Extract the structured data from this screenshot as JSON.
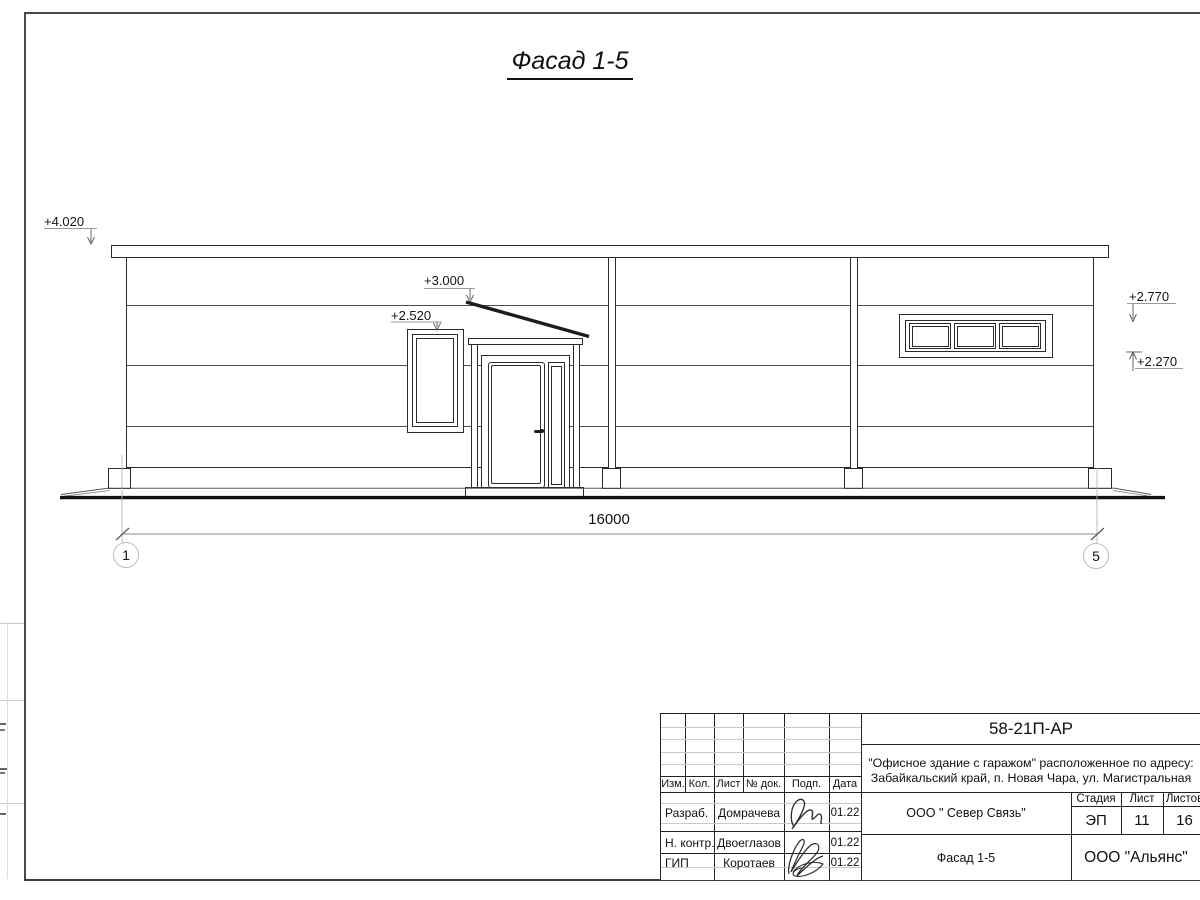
{
  "sheet": {
    "title": "Фасад 1-5"
  },
  "elevation_marks": {
    "m4020": "+4.020",
    "m3000": "+3.000",
    "m2520": "+2.520",
    "m2770": "+2.770",
    "m2270": "+2.270"
  },
  "dimension": {
    "value": "16000"
  },
  "grid": {
    "left_axis": "1",
    "right_axis": "5"
  },
  "title_block": {
    "doc_code": "58-21П-АР",
    "project_line1": "\"Офисное здание с гаражом\" расположенное по адресу:",
    "project_line2": "Забайкальский край, п. Новая Чара, ул. Магистральная",
    "header": {
      "izm": "Изм.",
      "kol": "Кол.",
      "list": "Лист",
      "doc": "№ док.",
      "podp": "Подп.",
      "data": "Дата"
    },
    "rows": [
      {
        "role": "Разраб.",
        "name": "Домрачева",
        "date": "01.22"
      },
      {
        "role": "Н. контр.",
        "name": "Двоеглазов",
        "date": "01.22"
      },
      {
        "role": "ГИП",
        "name": "Коротаев",
        "date": "01.22"
      }
    ],
    "org": "ООО \" Север Связь\"",
    "drawing_name": "Фасад 1-5",
    "stage_label": "Стадия",
    "stage": "ЭП",
    "sheet_label": "Лист",
    "sheet_no": "11",
    "sheets_label": "Листов",
    "sheets_total": "16",
    "company": "ООО \"Альянс\""
  }
}
